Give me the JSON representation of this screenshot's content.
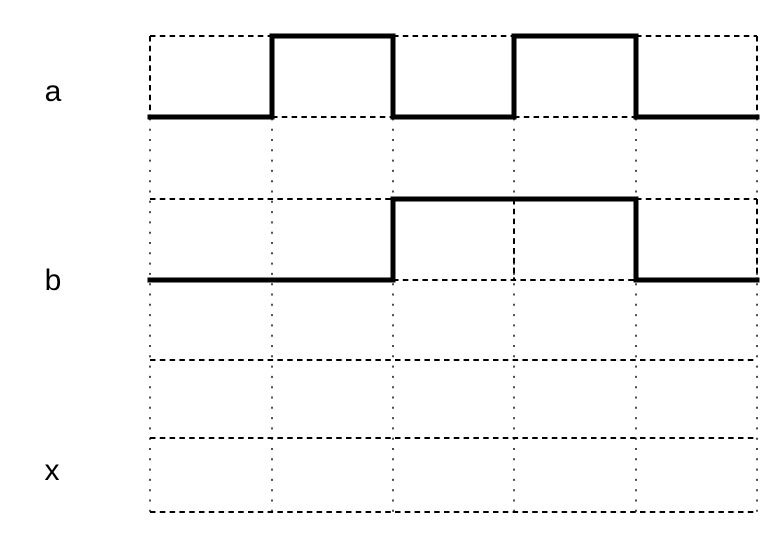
{
  "diagram": {
    "type": "logic-timing-diagram",
    "background_color": "#ffffff",
    "waveform_color": "#000000",
    "grid_dot_color": "#4d4d4d",
    "columns_x": [
      150,
      272,
      393,
      514,
      636,
      757
    ],
    "grid_top_y": 36,
    "grid_bottom_y": 512,
    "separator_rows_y": [
      360
    ],
    "signals": [
      {
        "name": "a",
        "label": "a",
        "high_y": 36,
        "low_y": 117,
        "values_per_column": [
          0,
          1,
          0,
          1,
          0
        ],
        "dashed_vertical_xs": [
          150,
          757
        ]
      },
      {
        "name": "b",
        "label": "b",
        "high_y": 199,
        "low_y": 280,
        "values_per_column": [
          0,
          0,
          1,
          1,
          0
        ],
        "dashed_vertical_xs": [
          514,
          757
        ]
      },
      {
        "name": "x",
        "label": "x",
        "high_y": 438,
        "low_y": 512,
        "values_per_column": null,
        "dashed_vertical_xs": []
      }
    ]
  }
}
